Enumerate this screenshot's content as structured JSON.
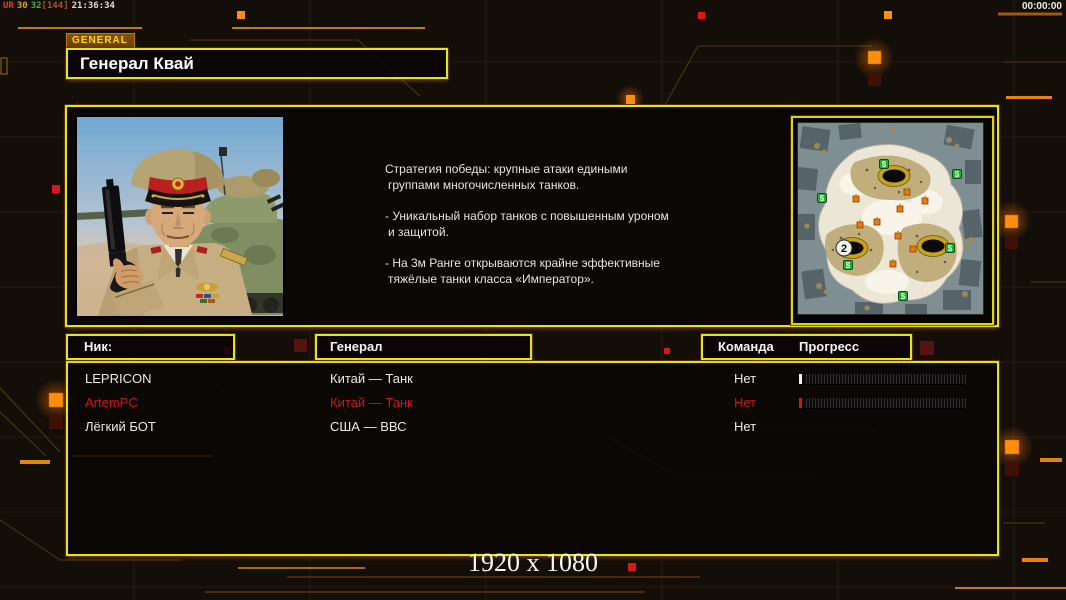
{
  "overlay": {
    "perf": {
      "app": "UR",
      "fps": "30",
      "frametime": "32",
      "bracket": "[144]",
      "clock": "21:36:34"
    },
    "timer": "00:00:00",
    "resolution_label": "1920 x 1080"
  },
  "header": {
    "tab": "GENERAL",
    "title": "Генерал Квай"
  },
  "general_info": {
    "description_lines": [
      "Стратегия победы: крупные атаки едиными",
      "группами многочисленных танков.",
      "- Уникальный набор танков с повышенным уроном",
      "и защитой.",
      "- На 3м Ранге открываются крайне эффективные",
      "тяжёлые танки класса «Император»."
    ]
  },
  "map": {
    "start_marker": {
      "label": "2",
      "x": 47,
      "y": 126
    },
    "supply_symbol": "$",
    "supplies": [
      [
        87,
        42
      ],
      [
        160,
        52
      ],
      [
        25,
        76
      ],
      [
        51,
        143
      ],
      [
        153,
        126
      ],
      [
        106,
        174
      ]
    ],
    "derricks": [
      [
        110,
        70
      ],
      [
        128,
        79
      ],
      [
        103,
        87
      ],
      [
        59,
        77
      ],
      [
        80,
        100
      ],
      [
        63,
        103
      ],
      [
        101,
        114
      ],
      [
        116,
        127
      ],
      [
        96,
        142
      ]
    ],
    "craters": [
      [
        97,
        54
      ],
      [
        55,
        126
      ],
      [
        136,
        124
      ]
    ]
  },
  "roster": {
    "headers": {
      "nick": "Ник:",
      "general": "Генерал",
      "team": "Команда",
      "progress": "Прогресс"
    },
    "players": [
      {
        "nick": "LEPRICON",
        "general": "Китай — Танк",
        "team": "Нет",
        "text_color": "#eaeaea",
        "progress": {
          "shown": true,
          "marker_color": "#f0f0f0",
          "value_percent": 0
        }
      },
      {
        "nick": "ArtemPC",
        "general": "Китай — Танк",
        "team": "Нет",
        "text_color": "#d01414",
        "progress": {
          "shown": true,
          "marker_color": "#d01414",
          "value_percent": 0
        }
      },
      {
        "nick": "Лёгкий БОТ",
        "general": "США — ВВС",
        "team": "Нет",
        "text_color": "#eaeaea",
        "progress": {
          "shown": false
        }
      }
    ]
  },
  "colors": {
    "accent_yellow": "#e8e318",
    "accent_orange": "#ff8d0e",
    "alert_red": "#d01414"
  }
}
